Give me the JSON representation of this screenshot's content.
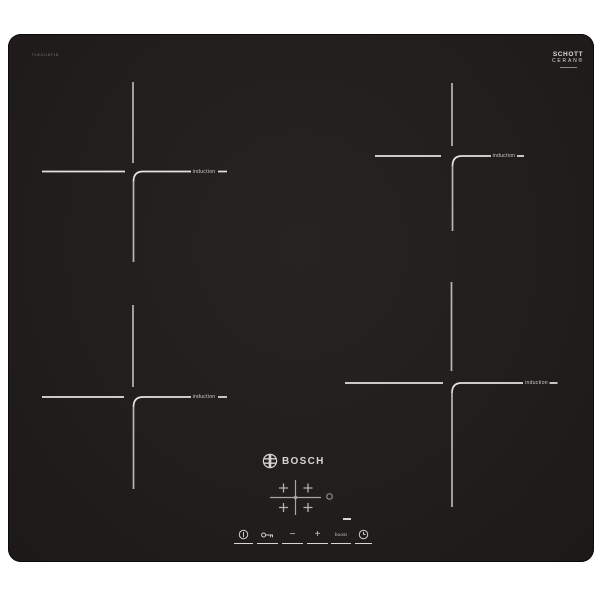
{
  "product": {
    "model_number": "PUE611BF1B"
  },
  "branding": {
    "bosch_logo": "BOSCH",
    "bosch_emblem_icon": "bosch-armature-icon",
    "schott_line1": "SCHOTT",
    "schott_line2": "CERAN®"
  },
  "zones": [
    {
      "position": "rear-left",
      "label": "induction"
    },
    {
      "position": "rear-right",
      "label": "induction"
    },
    {
      "position": "front-left",
      "label": "induction"
    },
    {
      "position": "front-right",
      "label": "induction"
    }
  ],
  "controls": {
    "zone_selector": {
      "icon": "zone-selector-diagram",
      "plus_glyph": "+"
    },
    "pan_indicator_icon": "ring-indicator",
    "boost_indicator_icon": "indicator-dash",
    "buttons": [
      {
        "name": "power",
        "icon": "power-icon"
      },
      {
        "name": "child-lock",
        "icon": "key-icon"
      },
      {
        "name": "decrease",
        "glyph": "−"
      },
      {
        "name": "increase",
        "glyph": "+"
      },
      {
        "name": "boost",
        "label": "boost"
      },
      {
        "name": "timer",
        "icon": "clock-icon"
      }
    ]
  },
  "colors": {
    "background": "#ffffff",
    "panel": "#211e1d",
    "line_horizontal": "#e4e2e0",
    "line_vertical": "#b8b6b4",
    "text": "#d4d2d0"
  }
}
